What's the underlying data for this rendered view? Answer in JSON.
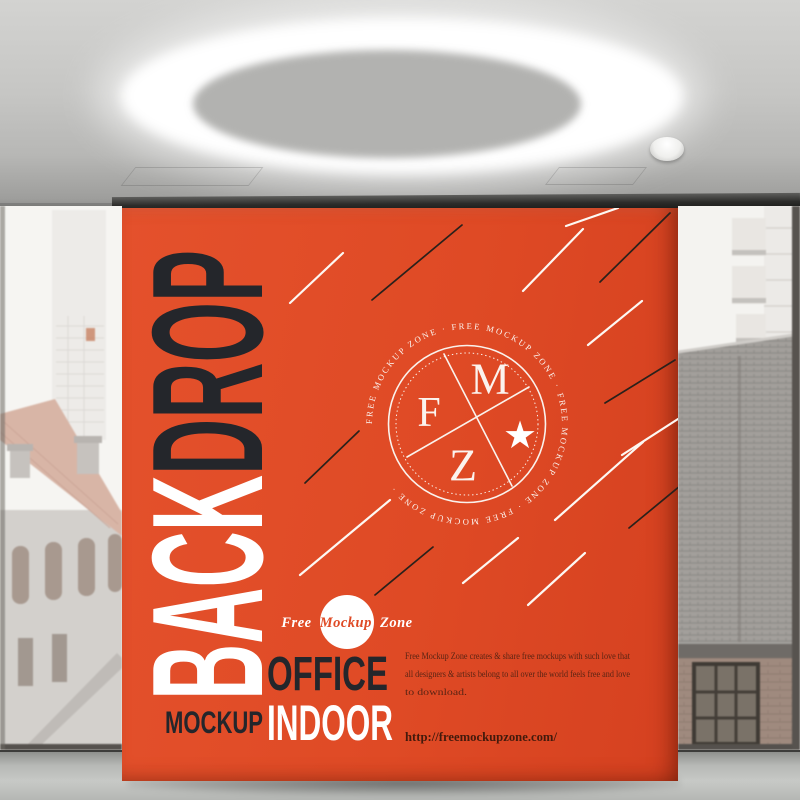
{
  "poster": {
    "vertical_word": {
      "back": "BACK",
      "drop": "DROP"
    },
    "badge": {
      "circular_text": "FREE MOCKUP ZONE  ·  FREE MOCKUP ZONE  ·  FREE MOCKUP ZONE  ·  FREE MOCKUP ZONE  ·",
      "letter_f": "F",
      "letter_m": "M",
      "letter_z": "Z",
      "star": "★"
    },
    "script_logo": {
      "free": "Free",
      "mockup": "Mockup",
      "zone": "Zone"
    },
    "titles": {
      "office": "OFFICE",
      "indoor": "INDOOR",
      "mockup": "MOCKUP"
    },
    "description_lines": [
      "Free Mockup Zone creates & share free mockups with such love that",
      "all designers & artists belong to all over the world feels free and love",
      "to download."
    ],
    "url": "http://freemockupzone.com/"
  },
  "colors": {
    "poster_orange": "#DF4A25",
    "ink_dark": "#24262B",
    "text_brown": "#4B2012",
    "line_white": "#FDF8F3",
    "ceiling_grey": "#C6C6C4"
  }
}
